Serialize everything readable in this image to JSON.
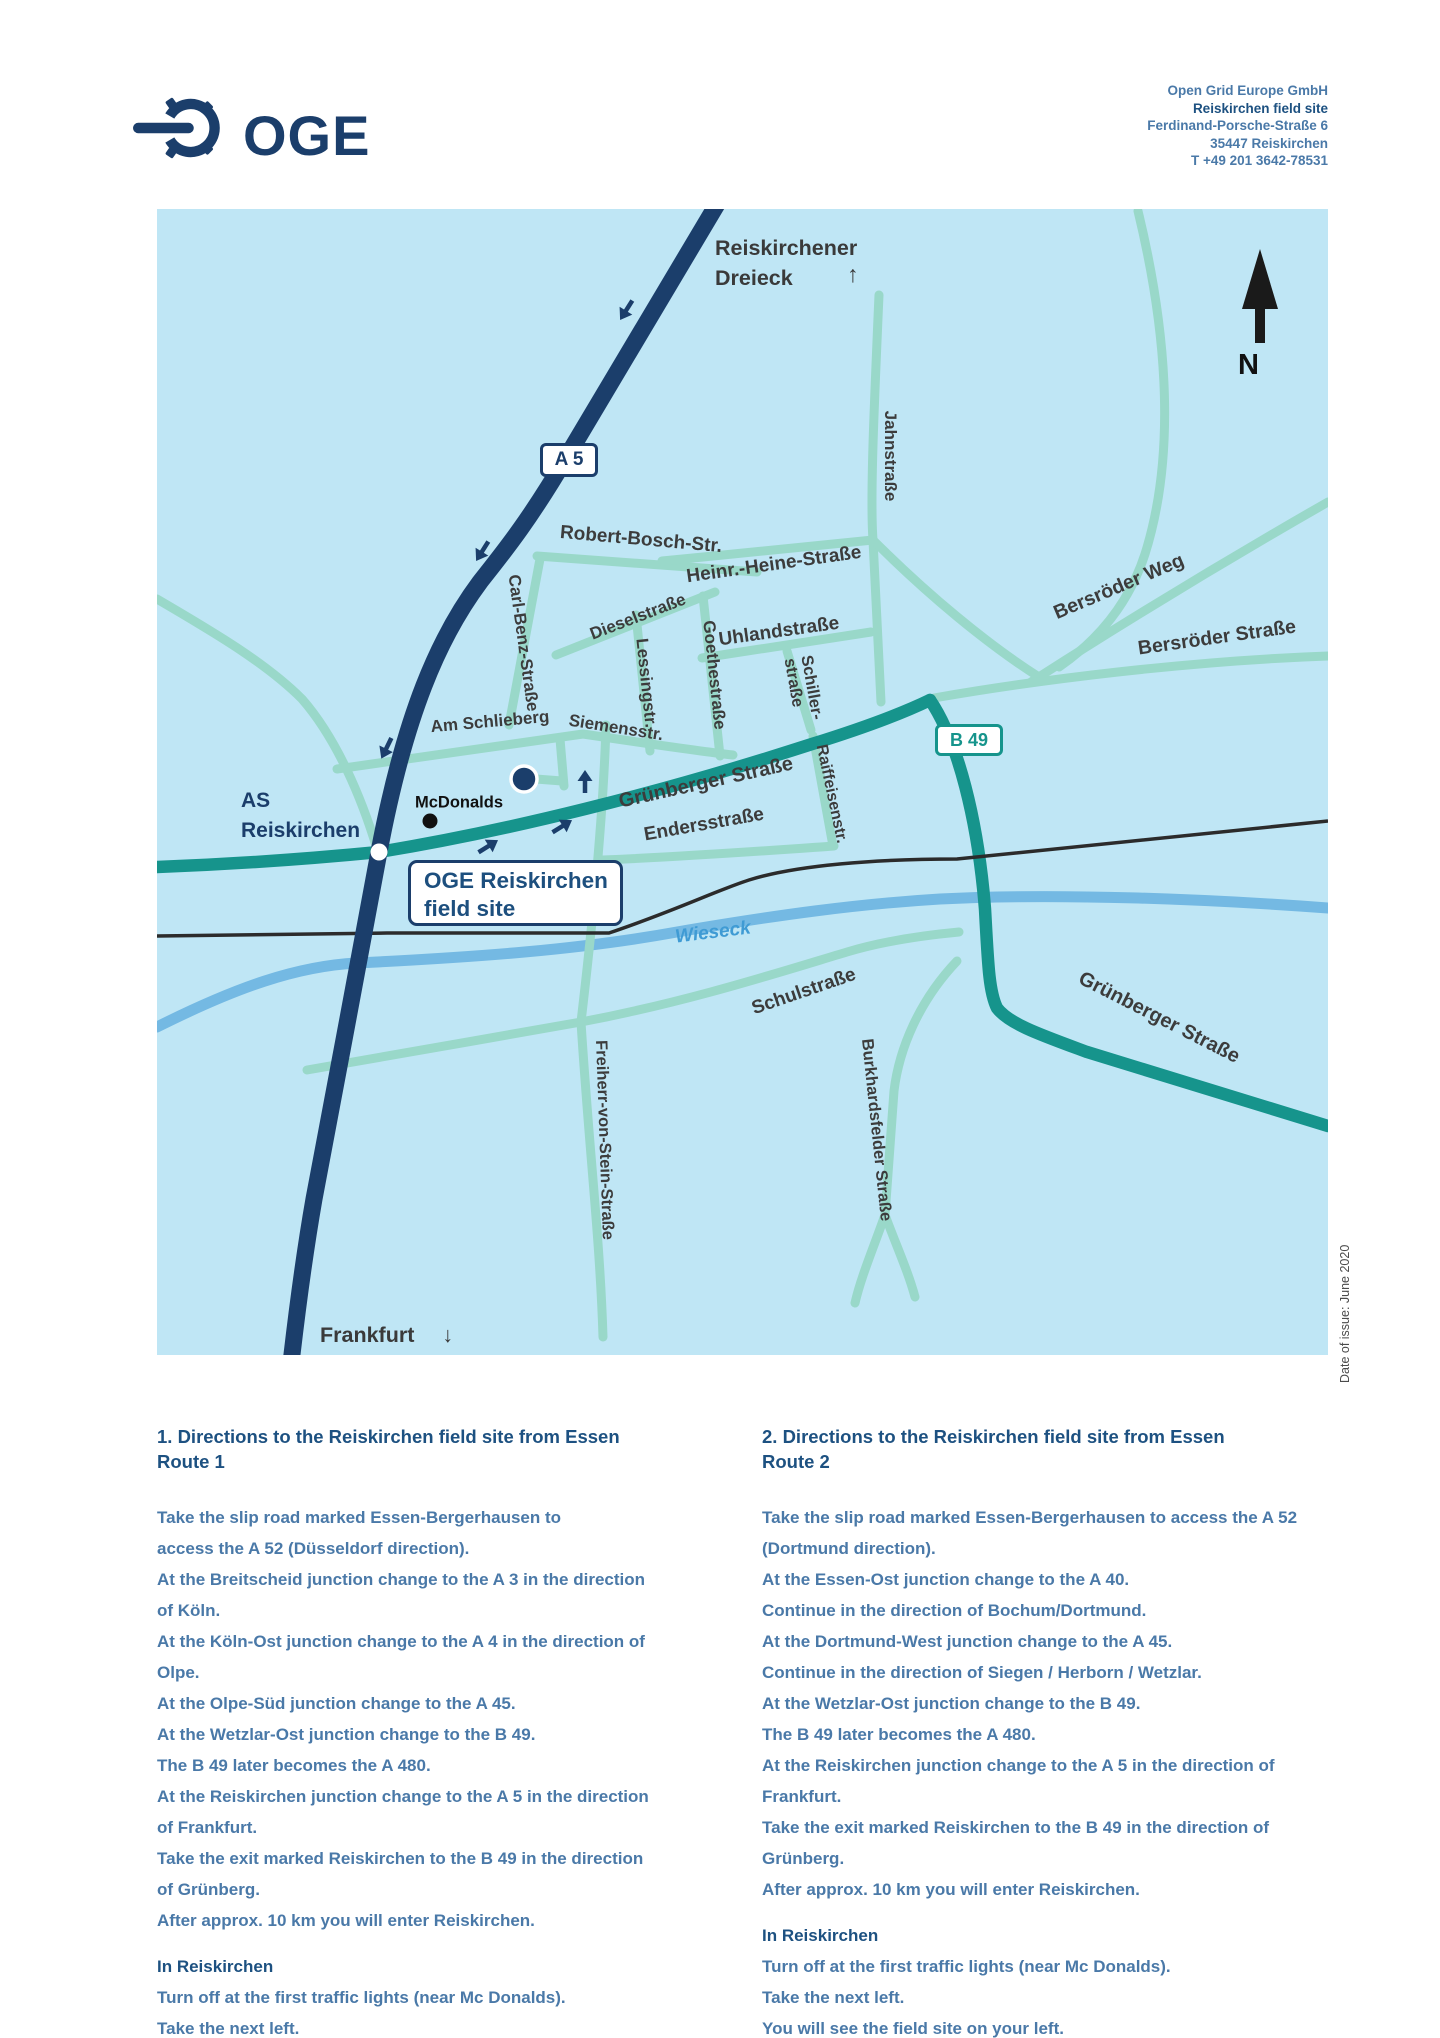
{
  "colors": {
    "brand_navy": "#1b3e6b",
    "heading_blue": "#1d5181",
    "body_blue": "#4a79a8",
    "map_background": "#bfe6f5",
    "road_minor_teal": "#99d8c9",
    "road_major_teal": "#16948c",
    "river_blue": "#74b9e3",
    "railway_black": "#2b2b2b",
    "street_label_gray": "#3c3c3c"
  },
  "header": {
    "logo_text": "OGE",
    "company": "Open Grid Europe GmbH",
    "site": "Reiskirchen field site",
    "street": "Ferdinand-Porsche-Straße 6",
    "city": "35447 Reiskirchen",
    "phone": "T +49 201 3642-78531"
  },
  "map": {
    "badge_a5": "A 5",
    "badge_b49": "B 49",
    "north": "N",
    "dreieck_line1": "Reiskirchener",
    "dreieck_line2": "Dreieck",
    "dreieck_arrow": "↑",
    "frankfurt": "Frankfurt",
    "frankfurt_arrow": "↓",
    "as_line1": "AS",
    "as_line2": "Reiskirchen",
    "mcdonalds": "McDonalds",
    "site_line1": "OGE Reiskirchen",
    "site_line2": "field site",
    "river_label": "Wieseck",
    "streets": {
      "robert_bosch": "Robert-Bosch-Str.",
      "carl_benz": "Carl-Benz-Straße",
      "diesel": "Dieselstraße",
      "lessing": "Lessingstr.",
      "goethe": "Goethestraße",
      "heine": "Heinr.-Heine-Straße",
      "uhland": "Uhlandstraße",
      "schiller_l1": "Schiller-",
      "schiller_l2": "straße",
      "jahn": "Jahnstraße",
      "bersroeder_weg": "Bersröder Weg",
      "bersroeder_str": "Bersröder Straße",
      "am_schlieberg": "Am Schlieberg",
      "siemens": "Siemensstr.",
      "gruenberger": "Grünberger Straße",
      "enders": "Endersstraße",
      "raiffeisen": "Raiffeisenstr.",
      "schul": "Schulstraße",
      "freiherr": "Freiherr-von-Stein-Straße",
      "burkhardsfelder": "Burkhardsfelder Straße"
    }
  },
  "sections": {
    "left": {
      "heading": "1. Directions to the Reiskirchen field site from Essen\nRoute 1",
      "body_lines": [
        "Take the slip road marked Essen-Bergerhausen to",
        "access the A 52 (Düsseldorf direction).",
        "At the Breitscheid junction change to the A 3 in the direction",
        "of Köln.",
        "At the Köln-Ost junction change to the A 4 in the direction of",
        "Olpe.",
        "At the Olpe-Süd junction change to the A 45.",
        "At the Wetzlar-Ost junction change to the B 49.",
        "The B 49 later becomes the A 480.",
        "At the Reiskirchen junction change to the A 5 in the direction",
        "of Frankfurt.",
        "Take the exit marked Reiskirchen to the B 49 in the direction",
        "of Grünberg.",
        "After approx. 10 km you will enter Reiskirchen."
      ],
      "sub_heading": "In Reiskirchen",
      "sub_lines": [
        "Turn off at the first traffic lights (near Mc Donalds).",
        "Take the next left.",
        "You will see the field site on your left."
      ]
    },
    "right": {
      "heading": "2. Directions to the Reiskirchen field site from Essen\nRoute 2",
      "body_lines": [
        "Take the slip road marked Essen-Bergerhausen to access the A 52",
        "(Dortmund direction).",
        "At the Essen-Ost junction change to the A 40.",
        "Continue in the direction of Bochum/Dortmund.",
        "At the Dortmund-West junction change to the A 45.",
        "Continue in the direction of Siegen / Herborn / Wetzlar.",
        "At the Wetzlar-Ost junction change to the B 49.",
        "The B 49 later becomes the A 480.",
        "At the Reiskirchen junction change to the A 5 in the direction of",
        "Frankfurt.",
        "Take the exit marked Reiskirchen to the B 49 in the direction of",
        "Grünberg.",
        "After approx. 10 km you will enter Reiskirchen."
      ],
      "sub_heading": "In Reiskirchen",
      "sub_lines": [
        "Turn off at the first traffic lights (near Mc Donalds).",
        "Take the next left.",
        "You will see the field site on your left."
      ]
    }
  },
  "footnote": "Date of issue: June 2020"
}
